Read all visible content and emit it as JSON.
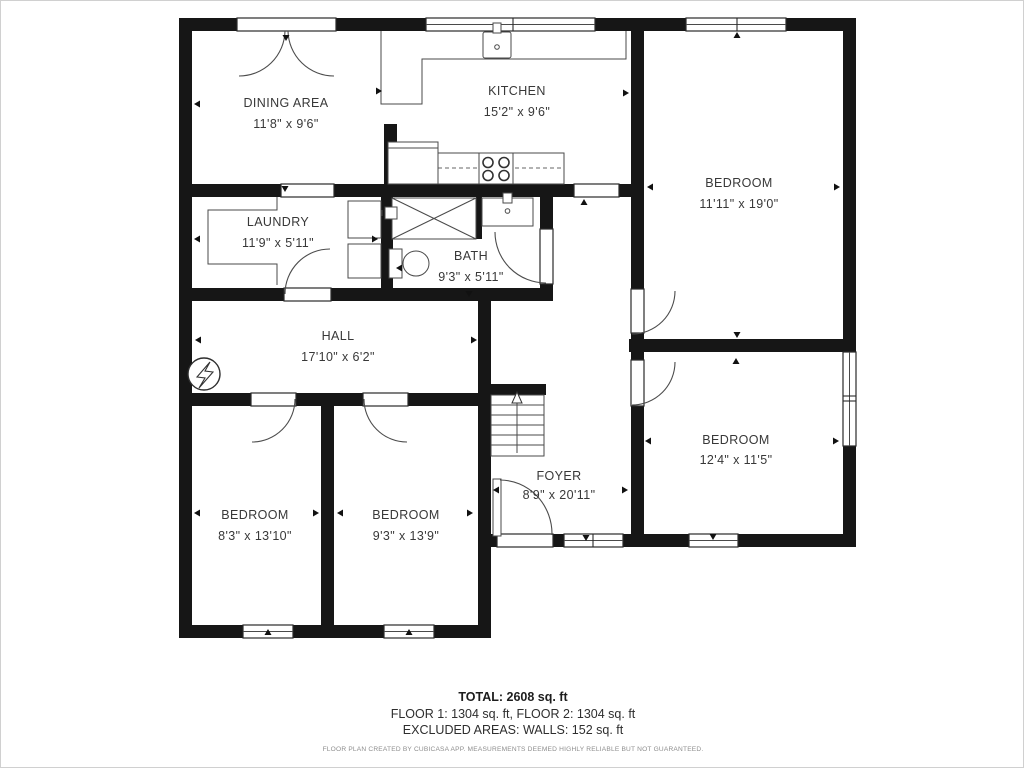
{
  "plan": {
    "rooms": [
      {
        "id": "dining",
        "name": "DINING AREA",
        "dims": "11'8\" x 9'6\""
      },
      {
        "id": "kitchen",
        "name": "KITCHEN",
        "dims": "15'2\" x 9'6\""
      },
      {
        "id": "bedroom-top-right",
        "name": "BEDROOM",
        "dims": "11'11\" x 19'0\""
      },
      {
        "id": "laundry",
        "name": "LAUNDRY",
        "dims": "11'9\" x 5'11\""
      },
      {
        "id": "bath",
        "name": "BATH",
        "dims": "9'3\" x 5'11\""
      },
      {
        "id": "hall",
        "name": "HALL",
        "dims": "17'10\" x 6'2\""
      },
      {
        "id": "foyer",
        "name": "FOYER",
        "dims": "8'9\" x 20'11\""
      },
      {
        "id": "bedroom-mid-right",
        "name": "BEDROOM",
        "dims": "12'4\" x 11'5\""
      },
      {
        "id": "bedroom-bottom-left",
        "name": "BEDROOM",
        "dims": "8'3\" x 13'10\""
      },
      {
        "id": "bedroom-bottom-mid",
        "name": "BEDROOM",
        "dims": "9'3\" x 13'9\""
      }
    ],
    "summary": {
      "total": "TOTAL: 2608 sq. ft",
      "floors": "FLOOR 1: 1304 sq. ft, FLOOR 2: 1304 sq. ft",
      "excluded": "EXCLUDED AREAS: WALLS: 152 sq. ft"
    },
    "footer": "FLOOR PLAN CREATED BY CUBICASA APP. MEASUREMENTS DEEMED HIGHLY RELIABLE BUT NOT GUARANTEED.",
    "colors": {
      "wall": "#161616",
      "text": "#383838",
      "fixture": "#4a4a4a",
      "muted": "#8d8d8d"
    }
  }
}
